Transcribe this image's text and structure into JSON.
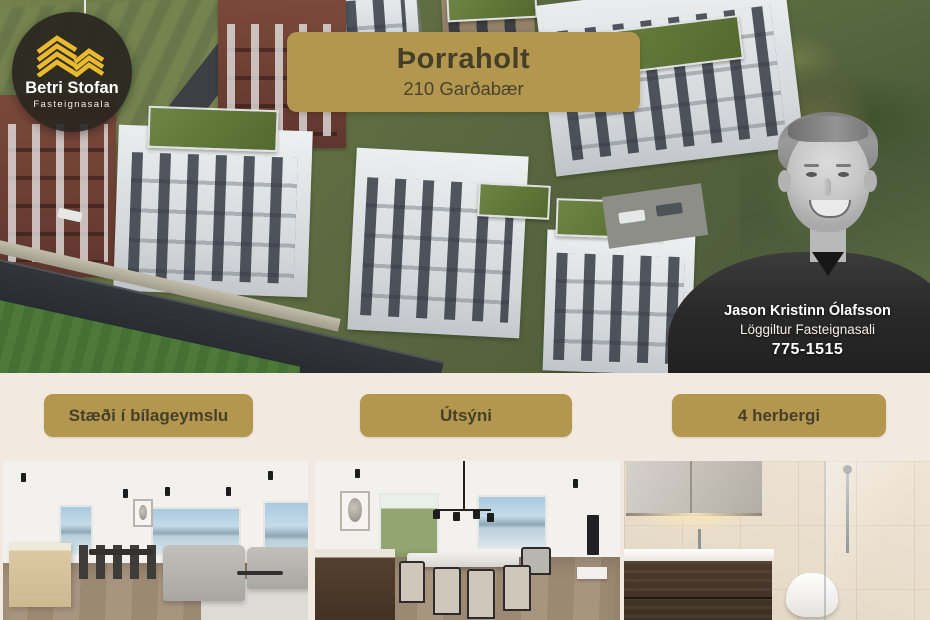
{
  "theme": {
    "accent_gold": "#b3974f",
    "text_on_gold": "#46402a",
    "cream_background": "#f2eae1",
    "logo_background": "#28231e",
    "logo_gold": "#eaba2e",
    "text_white": "#ffffff"
  },
  "logo": {
    "brand": "Betri Stofan",
    "tagline": "Fasteignasala",
    "icon": "gold-chevrons-icon"
  },
  "property_banner": {
    "title": "Þorraholt",
    "subtitle": "210 Garðabær"
  },
  "agent": {
    "name": "Jason Kristinn Ólafsson",
    "title": "Löggiltur Fasteignasali",
    "phone": "775-1515"
  },
  "features": [
    {
      "label": "Stæði í bílageymslu"
    },
    {
      "label": "Útsýni"
    },
    {
      "label": "4 herbergi"
    }
  ]
}
